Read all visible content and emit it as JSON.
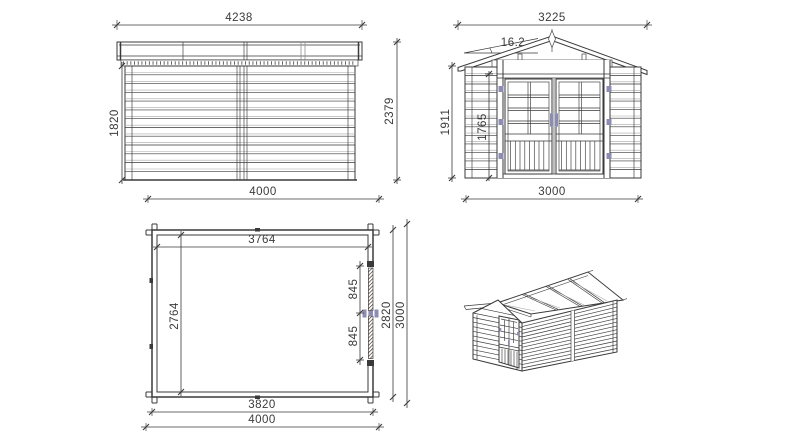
{
  "document": {
    "type": "technical-drawing",
    "subject": "log cabin garden shed",
    "background": "#ffffff"
  },
  "colors": {
    "line": "#3a3a3a",
    "light_line": "#a8a8a8",
    "hardware": "#8d8db4",
    "hatch": "#4a382e"
  },
  "views": {
    "side_elevation": {
      "label": "side-elevation",
      "roof_length": "4238",
      "wall_height": "1820",
      "overall_height": "2379",
      "wall_length": "4000"
    },
    "front_elevation": {
      "label": "front-elevation",
      "roof_width": "3225",
      "roof_pitch": "16.2",
      "eave_height": "1911",
      "door_height": "1765",
      "wall_width": "3000"
    },
    "floor_plan": {
      "label": "floor-plan",
      "interior_width": "3764",
      "interior_depth": "2764",
      "door_leaf_upper": "845",
      "door_leaf_lower": "845",
      "wall_depth": "2820",
      "overall_depth": "3000",
      "wall_width": "3820",
      "overall_width": "4000"
    },
    "perspective": {
      "label": "perspective-view"
    }
  }
}
